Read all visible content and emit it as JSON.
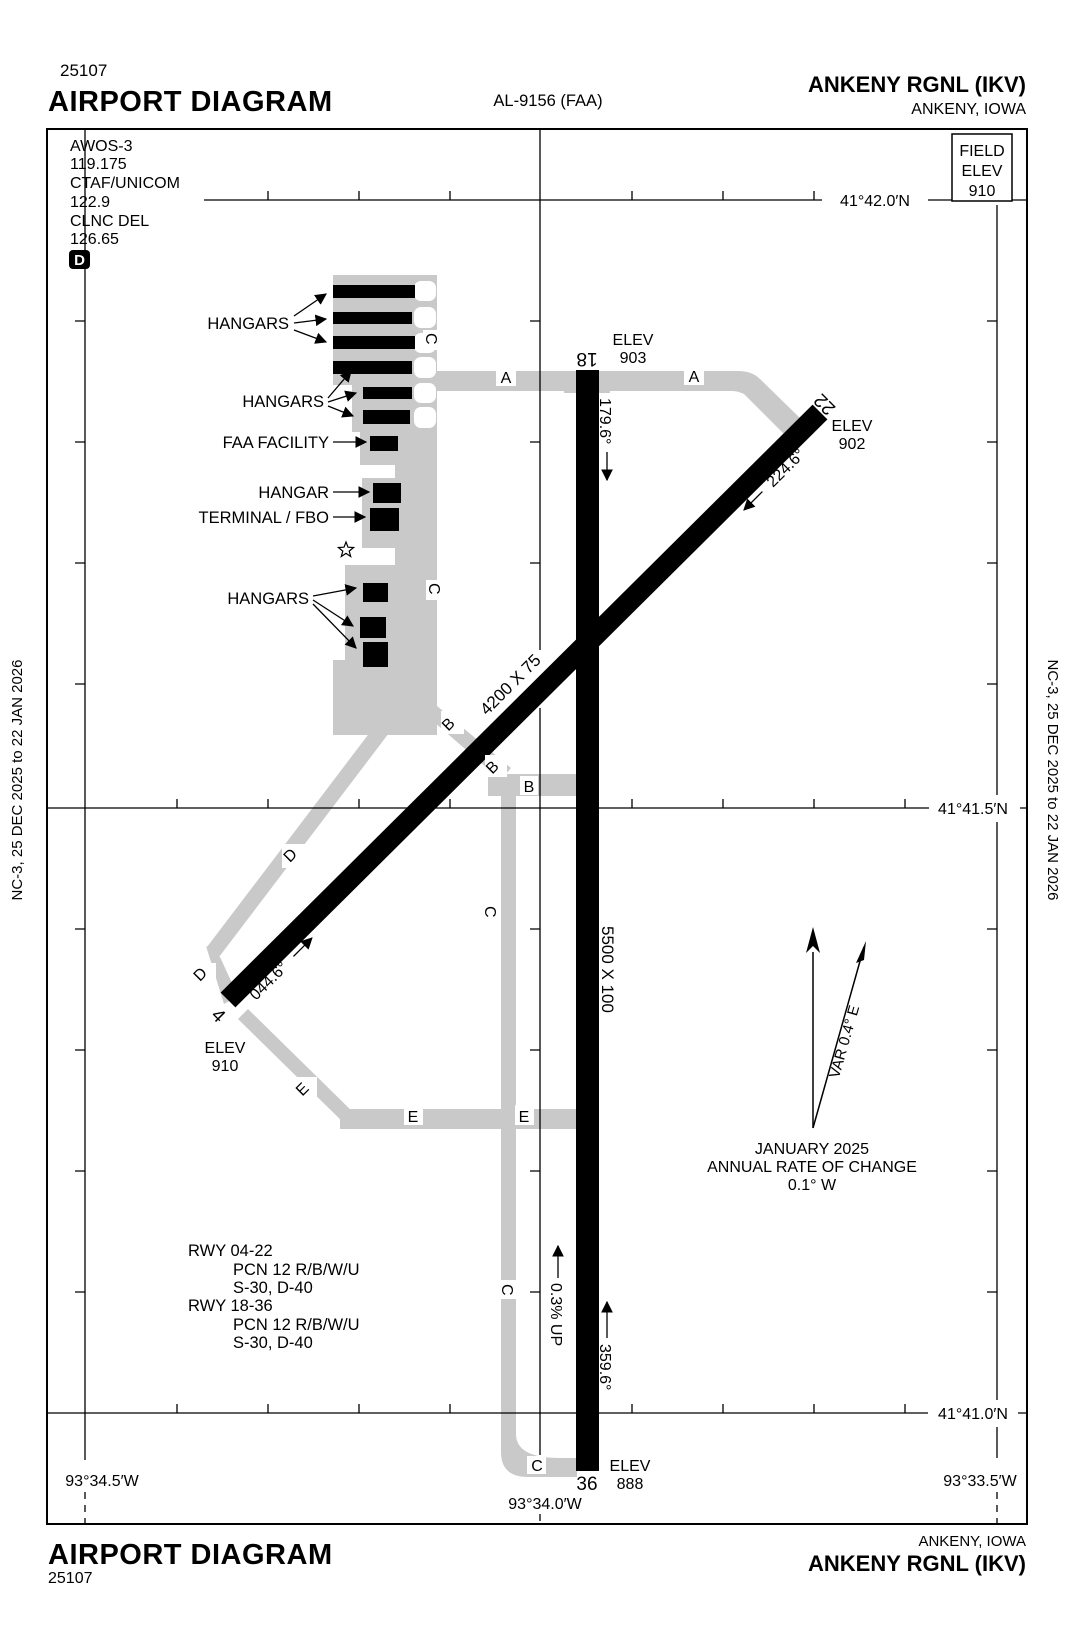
{
  "header": {
    "proc_num": "25107",
    "title": "AIRPORT DIAGRAM",
    "chart_ref": "AL-9156 (FAA)",
    "airport": "ANKENY RGNL  (IKV)",
    "city": "ANKENY, IOWA"
  },
  "footer": {
    "title": "AIRPORT DIAGRAM",
    "proc_num": "25107",
    "city": "ANKENY, IOWA",
    "airport": "ANKENY RGNL  (IKV)"
  },
  "edition": {
    "text": "NC-3,  25 DEC 2025  to  22 JAN 2026"
  },
  "comm": {
    "awos_label": "AWOS-3",
    "awos_freq": "119.175",
    "ctaf_label": "CTAF/UNICOM",
    "ctaf_freq": "122.9",
    "clnc_label": "CLNC DEL",
    "clnc_freq": "126.65",
    "delivery_badge": "D"
  },
  "field_elev": {
    "l1": "FIELD",
    "l2": "ELEV",
    "value": "910"
  },
  "grid": {
    "lat_42_0": "41°42.0′N",
    "lat_41_5": "41°41.5′N",
    "lat_41_0": "41°41.0′N",
    "lon_34_5": "93°34.5′W",
    "lon_34_0": "93°34.0′W",
    "lon_33_5": "93°33.5′W"
  },
  "labels": {
    "elev": "ELEV"
  },
  "rwy18_36": {
    "n18": "18",
    "n36": "36",
    "dim": "5500 X 100",
    "hdg18": "179.6°",
    "hdg36": "359.6°",
    "elev18": "903",
    "elev36": "888",
    "slope": "0.3% UP"
  },
  "rwy04_22": {
    "n4": "4",
    "n22": "22",
    "dim": "4200 X 75",
    "hdg04": "044.6°",
    "hdg22": "224.6°",
    "elev4": "910",
    "elev22": "902"
  },
  "twy": {
    "a": "A",
    "b": "B",
    "c": "C",
    "d": "D",
    "e": "E"
  },
  "bldg": {
    "hangars": "HANGARS",
    "faa": "FAA FACILITY",
    "hangar": "HANGAR",
    "terminal": "TERMINAL / FBO"
  },
  "notes": {
    "var": "VAR 0.4° E",
    "date": "JANUARY 2025",
    "rate": "ANNUAL RATE OF CHANGE",
    "rate_val": "0.1° W",
    "rwy0422": "RWY 04-22",
    "pcn0422": "PCN 12 R/B/W/U",
    "s0422": "S-30, D-40",
    "rwy1836": "RWY 18-36",
    "pcn1836": "PCN 12 R/B/W/U",
    "s1836": "S-30, D-40"
  },
  "colors": {
    "taxiway": "#c9c9c9",
    "runway": "#000000",
    "ink": "#000000",
    "paper": "#ffffff"
  }
}
